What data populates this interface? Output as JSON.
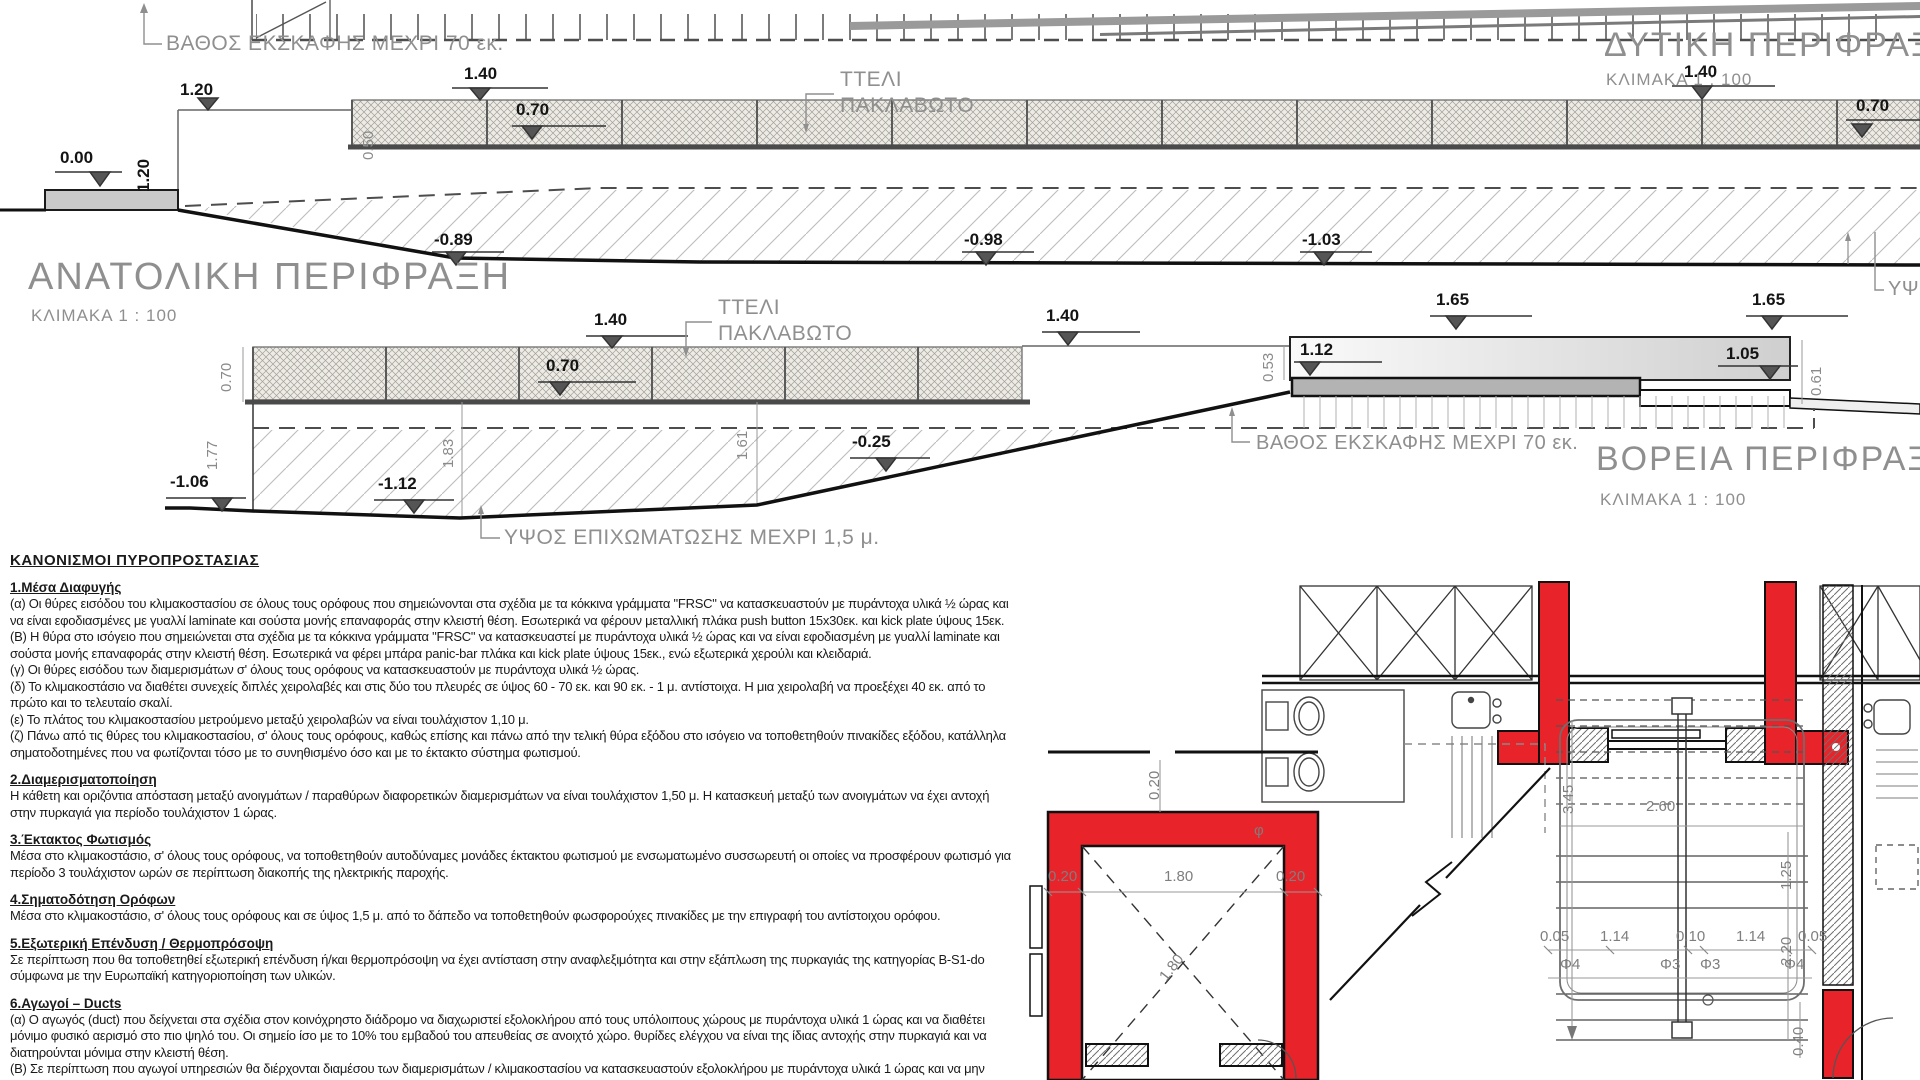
{
  "drawings": {
    "east": {
      "title": "ΑΝΑΤΟΛΙΚΗ ΠΕΡΙΦΡΑΞΗ",
      "scale_label": "ΚΛΙΜΑΚΑ 1 : 100"
    },
    "west": {
      "title": "ΔΥΤΙΚΗ ΠΕΡΙΦΡΑΞΗ",
      "scale_label": "ΚΛΙΜΑΚΑ 1 : 100"
    },
    "north": {
      "title": "ΒΟΡΕΙΑ ΠΕΡΙΦΡΑΞΗ",
      "scale_label": "ΚΛΙΜΑΚΑ 1 : 100"
    }
  },
  "notes": {
    "excavation_top": "ΒΑΘΟΣ ΕΚΣΚΑΦΗΣ ΜΕΧΡΙ 70 εκ.",
    "excavation_north": "ΒΑΘΟΣ ΕΚΣΚΑΦΗΣ ΜΕΧΡΙ 70 εκ.",
    "mesh_top_line1": "ΤΤΕΛΙ",
    "mesh_top_line2": "ΠΑΚΛΑΒΩΤΟ",
    "mesh_east_line1": "ΤΤΕΛΙ",
    "mesh_east_line2": "ΠΑΚΛΑΒΩΤΟ",
    "fill_height": "ΥΨΟΣ ΕΠΙΧΩΜΑΤΩΣΗΣ ΜΕΧΡΙ 1,5 μ.",
    "edge_cut": "ΥΨΟ"
  },
  "labels": [
    {
      "t": "0.00",
      "x": 60,
      "y": 148,
      "c": "lvl"
    },
    {
      "t": "1.20",
      "x": 180,
      "y": 80,
      "c": "lvl"
    },
    {
      "t": "1.20",
      "x": 134,
      "y": 192,
      "c": "lvl",
      "r": -90
    },
    {
      "t": "0.50",
      "x": 360,
      "y": 160,
      "c": "dimv",
      "r": -90
    },
    {
      "t": "1.40",
      "x": 464,
      "y": 64,
      "c": "lvl"
    },
    {
      "t": "0.70",
      "x": 516,
      "y": 100,
      "c": "lvl"
    },
    {
      "t": "1.40",
      "x": 1684,
      "y": 62,
      "c": "lvl"
    },
    {
      "t": "0.70",
      "x": 1856,
      "y": 96,
      "c": "lvl"
    },
    {
      "t": "-0.89",
      "x": 434,
      "y": 230,
      "c": "lvl"
    },
    {
      "t": "-0.98",
      "x": 964,
      "y": 230,
      "c": "lvl"
    },
    {
      "t": "-1.03",
      "x": 1302,
      "y": 230,
      "c": "lvl"
    },
    {
      "t": "0.70",
      "x": 218,
      "y": 392,
      "c": "dimv",
      "r": -90
    },
    {
      "t": "1.40",
      "x": 594,
      "y": 310,
      "c": "lvl"
    },
    {
      "t": "0.70",
      "x": 546,
      "y": 356,
      "c": "lvl"
    },
    {
      "t": "-1.06",
      "x": 170,
      "y": 472,
      "c": "lvl"
    },
    {
      "t": "-1.12",
      "x": 378,
      "y": 474,
      "c": "lvl"
    },
    {
      "t": "1.77",
      "x": 204,
      "y": 470,
      "c": "dimv",
      "r": -90
    },
    {
      "t": "1.83",
      "x": 440,
      "y": 468,
      "c": "dimv",
      "r": -90
    },
    {
      "t": "1.61",
      "x": 734,
      "y": 460,
      "c": "dimv",
      "r": -90
    },
    {
      "t": "-0.25",
      "x": 852,
      "y": 432,
      "c": "lvl"
    },
    {
      "t": "1.40",
      "x": 1046,
      "y": 306,
      "c": "lvl"
    },
    {
      "t": "0.53",
      "x": 1260,
      "y": 382,
      "c": "dimv",
      "r": -90
    },
    {
      "t": "1.12",
      "x": 1300,
      "y": 340,
      "c": "lvl"
    },
    {
      "t": "1.65",
      "x": 1436,
      "y": 290,
      "c": "lvl"
    },
    {
      "t": "1.65",
      "x": 1752,
      "y": 290,
      "c": "lvl"
    },
    {
      "t": "1.05",
      "x": 1726,
      "y": 344,
      "c": "lvl"
    },
    {
      "t": "0.61",
      "x": 1808,
      "y": 396,
      "c": "dimv",
      "r": -90
    },
    {
      "t": "2.60",
      "x": 1646,
      "y": 798,
      "c": "dimp"
    },
    {
      "t": "1.25",
      "x": 1778,
      "y": 890,
      "c": "dimp",
      "r": -90
    },
    {
      "t": "3.45",
      "x": 1560,
      "y": 814,
      "c": "dimp",
      "r": -90
    },
    {
      "t": "2.20",
      "x": 1778,
      "y": 966,
      "c": "dimp",
      "r": -90
    },
    {
      "t": "0.20",
      "x": 1146,
      "y": 800,
      "c": "dimp",
      "r": -90
    },
    {
      "t": "0.20",
      "x": 1048,
      "y": 868,
      "c": "dimp"
    },
    {
      "t": "1.80",
      "x": 1164,
      "y": 868,
      "c": "dimp"
    },
    {
      "t": "0.20",
      "x": 1276,
      "y": 868,
      "c": "dimp"
    },
    {
      "t": "1.80",
      "x": 1156,
      "y": 974,
      "c": "dimp",
      "r": -52
    },
    {
      "t": "0.05",
      "x": 1540,
      "y": 928,
      "c": "dimp"
    },
    {
      "t": "1.14",
      "x": 1600,
      "y": 928,
      "c": "dimp"
    },
    {
      "t": "0.10",
      "x": 1676,
      "y": 928,
      "c": "dimp"
    },
    {
      "t": "1.14",
      "x": 1736,
      "y": 928,
      "c": "dimp"
    },
    {
      "t": "0.05",
      "x": 1798,
      "y": 928,
      "c": "dimp"
    },
    {
      "t": "Φ4",
      "x": 1560,
      "y": 956,
      "c": "dimp"
    },
    {
      "t": "Φ3",
      "x": 1660,
      "y": 956,
      "c": "dimp"
    },
    {
      "t": "Φ3",
      "x": 1700,
      "y": 956,
      "c": "dimp"
    },
    {
      "t": "Φ4",
      "x": 1784,
      "y": 956,
      "c": "dimp"
    },
    {
      "t": "0.40",
      "x": 1790,
      "y": 1056,
      "c": "dimp",
      "r": -90
    },
    {
      "t": "φ",
      "x": 1254,
      "y": 822,
      "c": "dimp"
    }
  ],
  "regulations": {
    "heading": "ΚΑΝΟΝΙΣΜΟΙ  ΠΥΡΟΠΡΟΣΤΑΣΙΑΣ",
    "sections": [
      {
        "title": "1.Μέσα Διαφυγής",
        "paragraphs": [
          "(α) Οι θύρες εισόδου του κλιμακοστασίου σε όλους τους ορόφους που σημειώνονται στα σχέδια με τα κόκκινα γράμματα \"FRSC\" να κατασκευαστούν με πυράντοχα υλικά ½ ώρας και να είναι εφοδιασμένες με γυαλλί laminate και σούστα μονής επαναφοράς στην κλειστή θέση. Εσωτερικά να φέρουν μεταλλική πλάκα push button 15x30εκ. και kick plate ύψους 15εκ.",
          "(Β) Η θύρα στο ισόγειο που σημειώνεται στα σχέδια με τα κόκκινα γράμματα \"FRSC\" να κατασκευαστεί με πυράντοχα υλικά ½ ώρας και να είναι εφοδιασμένη με γυαλλί laminate και σούστα μονής επαναφοράς στην κλειστή θέση. Εσωτερικά να φέρει μπάρα panic-bar πλάκα και kick plate ύψους 15εκ., ενώ εξωτερικά χερούλι και κλειδαριά.",
          "(γ) Οι θύρες εισόδου των διαμερισμάτων σ' όλους τους ορόφους να κατασκευαστούν με πυράντοχα υλικά ½ ώρας.",
          "(δ) Το κλιμακοστάσιο να διαθέτει συνεχείς διπλές χειρολαβές και στις δύο του πλευρές σε ύψος 60 - 70 εκ. και 90 εκ. - 1 μ. αντίστοιχα. Η μια χειρολαβή να προεξέχει 40 εκ. από το πρώτο και το τελευταίο σκαλί.",
          "(ε) Το πλάτος του κλιμακοστασίου μετρούμενο μεταξύ χειρολαβών να είναι τουλάχιστον 1,10 μ.",
          "(ζ) Πάνω από τις θύρες του κλιμακοστασίου, σ' όλους τους ορόφους, καθώς επίσης και πάνω από την τελική θύρα εξόδου στο ισόγειο να τοποθετηθούν πινακίδες εξόδου, κατάλληλα σηματοδοτημένες που να φωτίζονται τόσο με το συνηθισμένο όσο και με το έκτακτο σύστημα φωτισμού."
        ]
      },
      {
        "title": "2.Διαμερισματοποίηση",
        "paragraphs": [
          "Η κάθετη και οριζόντια απόσταση μεταξύ ανοιγμάτων / παραθύρων διαφορετικών διαμερισμάτων να είναι τουλάχιστον 1,50 μ. Η κατασκευή μεταξύ των ανοιγμάτων να έχει αντοχή στην πυρκαγιά για περίοδο τουλάχιστον 1 ώρας."
        ]
      },
      {
        "title": "3.Έκτακτος Φωτισμός",
        "paragraphs": [
          "Μέσα στο κλιμακοστάσιο, σ' όλους τους ορόφους, να τοποθετηθούν αυτοδύναμες μονάδες έκτακτου φωτισμού με ενσωματωμένο συσσωρευτή οι οποίες να προσφέρουν φωτισμό για περίοδο 3 τουλάχιστον ωρών σε περίπτωση διακοπής της ηλεκτρικής παροχής."
        ]
      },
      {
        "title": "4.Σηματοδότηση Ορόφων",
        "paragraphs": [
          "Μέσα στο κλιμακοστάσιο, σ' όλους τους ορόφους και σε ύψος 1,5 μ. από το δάπεδο να τοποθετηθούν φωσφορούχες πινακίδες με την επιγραφή του αντίστοιχου ορόφου."
        ]
      },
      {
        "title": "5.Εξωτερική Επένδυση / Θερμοπρόσοψη",
        "paragraphs": [
          "Σε περίπτωση που θα τοποθετηθεί εξωτερική επένδυση ή/και θερμοπρόσοψη να έχει αντίσταση στην αναφλεξιμότητα και στην εξάπλωση της πυρκαγιάς της κατηγορίας B-S1-do σύμφωνα με την Ευρωπαϊκή κατηγοριοποίηση των υλικών.",
          ""
        ]
      },
      {
        "title": "6.Αγωγοί – Ducts",
        "paragraphs": [
          "(α) Ο αγωγός (duct) που δείχνεται στα σχέδια στον κοινόχρηστο διάδρομο να διαχωριστεί εξολοκλήρου από τους υπόλοιπους χώρους με πυράντοχα υλικά 1 ώρας και να διαθέτει μόνιμο φυσικό αερισμό στο πιο ψηλό του. Οι σημείο ίσο με το 10% του εμβαδού του απευθείας σε ανοιχτό χώρο. θυρίδες ελέγχου να είναι της ίδιας αντοχής στην πυρκαγιά και να διατηρούνται μόνιμα στην κλειστή θέση.",
          "(Β) Σε περίπτωση που αγωγοί υπηρεσιών θα διέρχονται διαμέσου των διαμερισμάτων / κλιμακοστασίου να κατασκευαστούν εξολοκλήρου με πυράντοχα υλικά 1 ώρας και να μην διαθέτουν θυρίδες"
        ]
      }
    ]
  },
  "colors": {
    "accent_red": "#e8232a",
    "line_dark": "#111111",
    "annotation_gray": "#8f8f8f"
  }
}
